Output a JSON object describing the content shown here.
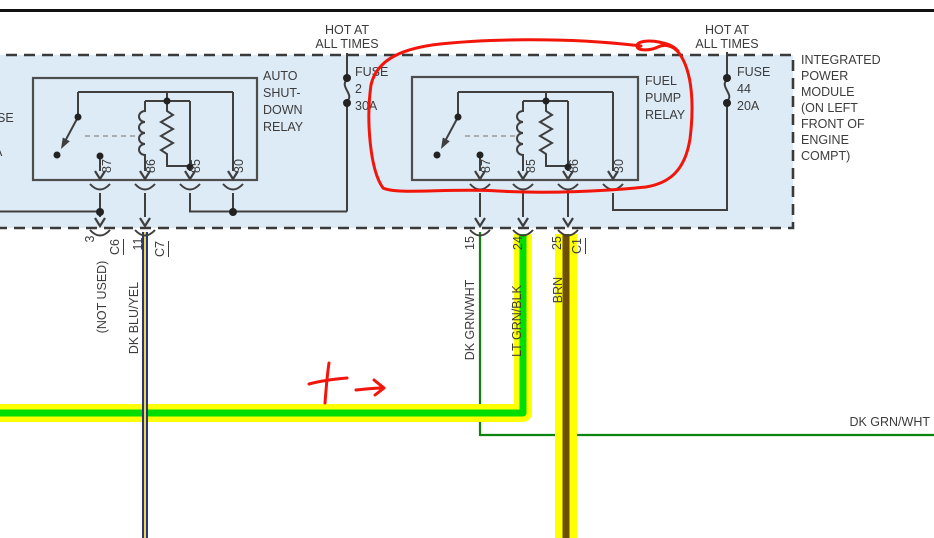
{
  "colors": {
    "module_fill": "#ddebf7",
    "circuit_line": "#3f3f3f",
    "text": "#3c3c3c",
    "red_annotation": "#f2150a",
    "highlight_yellow": "#ffff00",
    "lt_grn_wire": "#00dd00",
    "dk_grn_wire": "#0d840d",
    "brn_wire": "#6e4f00",
    "dk_blu_wire": "#2a3480",
    "yel_stripe": "#e9d94b"
  },
  "header": {
    "hot_left": "HOT AT\nALL TIMES",
    "hot_right": "HOT AT\nALL TIMES"
  },
  "fuses": {
    "fuse2": "FUSE\n2\n30A",
    "fuse44": "FUSE\n44\n20A"
  },
  "relays": {
    "asd": {
      "label": "AUTO\nSHUT-\nDOWN\nRELAY",
      "pins": [
        "87",
        "86",
        "85",
        "30"
      ]
    },
    "fuel_pump": {
      "label": "FUEL\nPUMP\nRELAY",
      "pins": [
        "87",
        "85",
        "86",
        "30"
      ]
    }
  },
  "module": {
    "label": "INTEGRATED\nPOWER\nMODULE\n(ON LEFT\nFRONT OF\nENGINE\nCOMPT)"
  },
  "edge_partials": {
    "fuse_fragment": "SE",
    "rating_fragment": "A"
  },
  "connectors": {
    "pin3": "3",
    "c6": "C6",
    "pin11": "11",
    "c7": "C7",
    "pin15": "15",
    "pin24": "24",
    "pin25": "25",
    "c1": "C1"
  },
  "wires": {
    "not_used": "(NOT USED)",
    "dk_blu_yel": "DK BLU/YEL",
    "dk_grn_wht": "DK GRN/WHT",
    "lt_grn_blk": "LT GRN/BLK",
    "brn": "BRN",
    "dk_grn_wht_right": "DK GRN/WHT"
  },
  "annotations": {
    "circle": "red-circle-annotation",
    "plus_arrow": "red-plus-arrow-annotation"
  }
}
